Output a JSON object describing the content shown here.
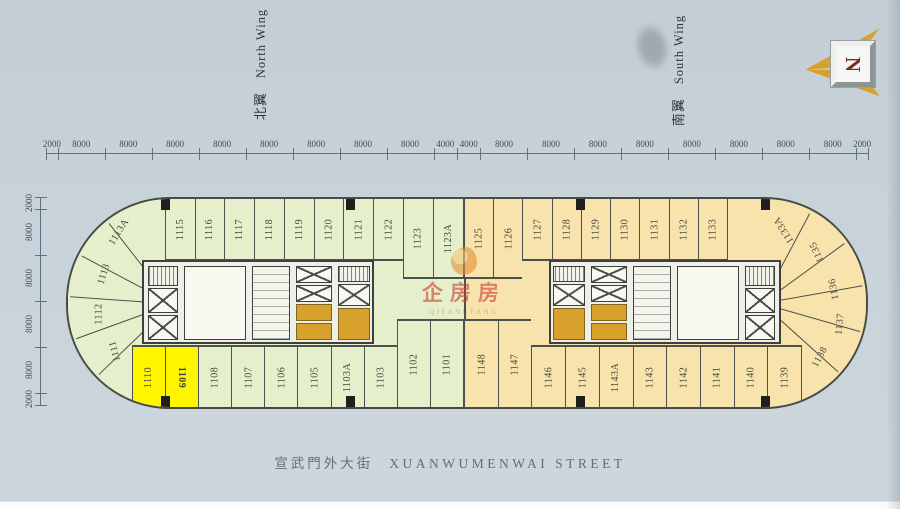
{
  "page": {
    "wing_labels": {
      "north_cn": "北翼",
      "north_en": "North Wing",
      "south_cn": "南翼",
      "south_en": "South Wing"
    },
    "street": {
      "cn": "宣武門外大街",
      "en": "XUANWUMENWAI STREET"
    },
    "compass": {
      "letter": "N"
    },
    "watermark": {
      "cn": "企房房",
      "en": "QIFANGFANG"
    }
  },
  "dimensions": {
    "top": [
      "2000",
      "8000",
      "8000",
      "8000",
      "8000",
      "8000",
      "8000",
      "8000",
      "8000",
      "4000",
      "4000",
      "8000",
      "8000",
      "8000",
      "8000",
      "8000",
      "8000",
      "8000",
      "8000",
      "2000"
    ],
    "left": [
      "2000",
      "8000",
      "8000",
      "8000",
      "8000",
      "2000"
    ]
  },
  "rooms": {
    "north_top": [
      "1115",
      "1116",
      "1117",
      "1118",
      "1119",
      "1120",
      "1121",
      "1122",
      "1123",
      "1123A"
    ],
    "north_curve": [
      "1113A",
      "1113",
      "1112",
      "1111"
    ],
    "north_bottom": [
      "1110",
      "1109",
      "1108",
      "1107",
      "1106",
      "1105",
      "1103A",
      "1103",
      "1102",
      "1101"
    ],
    "south_top": [
      "1125",
      "1126",
      "1127",
      "1128",
      "1129",
      "1130",
      "1131",
      "1132",
      "1133"
    ],
    "south_curve": [
      "1133A",
      "1135",
      "1136",
      "1137",
      "1138"
    ],
    "south_bottom": [
      "1148",
      "1147",
      "1146",
      "1145",
      "1143A",
      "1143",
      "1142",
      "1141",
      "1140",
      "1139"
    ],
    "highlighted": [
      "1110",
      "1109"
    ],
    "selected": "1109",
    "tall_top": [
      "1123",
      "1123A",
      "1125",
      "1126"
    ],
    "tall_bottom": [
      "1102",
      "1101",
      "1148",
      "1147"
    ]
  },
  "colors": {
    "north_wing": "#e6efcb",
    "south_wing": "#f9e3ac",
    "highlight": "#fff500",
    "gold_elevator": "#d7a12c",
    "watermark_red": "#c94432"
  }
}
